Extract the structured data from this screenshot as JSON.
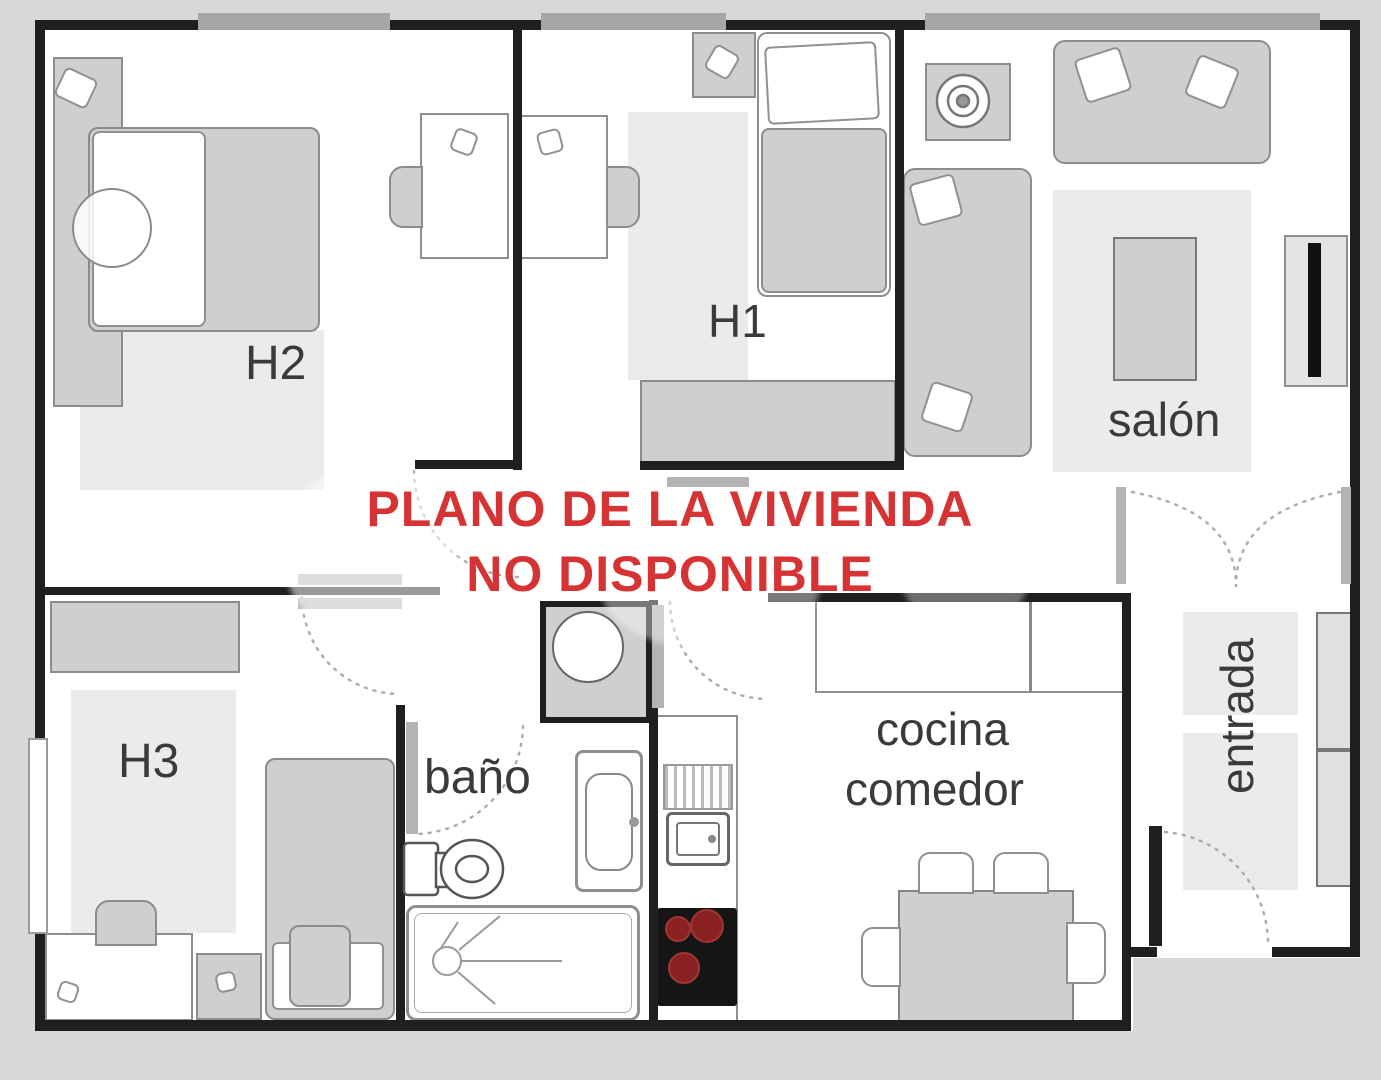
{
  "plan": {
    "watermark": {
      "line1": "PLANO DE LA VIVIENDA",
      "line2": "NO DISPONIBLE"
    },
    "labels": {
      "h1": "H1",
      "h2": "H2",
      "h3": "H3",
      "salon": "salón",
      "bano": "baño",
      "cocina": "cocina",
      "comedor": "comedor",
      "entrada": "entrada"
    },
    "colors": {
      "outside": "#d8d8d8",
      "floor": "#ffffff",
      "wall": "#1f1f1f",
      "furniture": "#cfcfcf",
      "furniture_border": "#8c8c8c",
      "rug": "#ebebeb",
      "window": "#a6a6a6",
      "door": "#b3b3b3",
      "label_text": "#3a3a3a",
      "watermark_red": "#d63434",
      "hob": "#151515",
      "burner": "#8a2222"
    }
  }
}
